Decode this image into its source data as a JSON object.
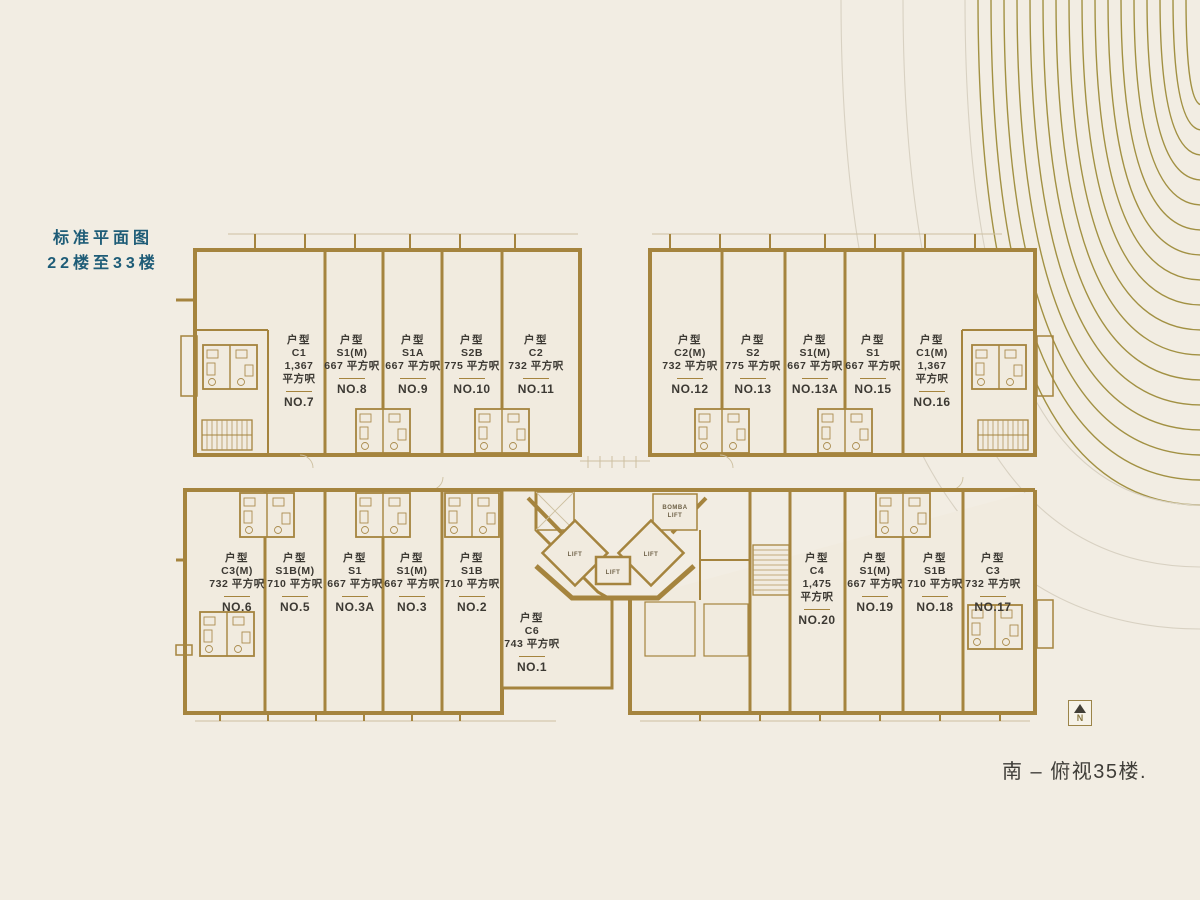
{
  "header": {
    "title_line1": "标准平面图",
    "title_line2": "22楼至33楼"
  },
  "plan": {
    "unit_prefix": "户型"
  },
  "units": {
    "top_left": [
      {
        "type": "C1",
        "area": "1,367 平方呎",
        "wrap": true,
        "no": "NO.7"
      },
      {
        "type": "S1(M)",
        "area": "667 平方呎",
        "wrap": false,
        "no": "NO.8"
      },
      {
        "type": "S1A",
        "area": "667 平方呎",
        "wrap": false,
        "no": "NO.9"
      },
      {
        "type": "S2B",
        "area": "775 平方呎",
        "wrap": false,
        "no": "NO.10"
      },
      {
        "type": "C2",
        "area": "732 平方呎",
        "wrap": false,
        "no": "NO.11"
      }
    ],
    "top_right": [
      {
        "type": "C2(M)",
        "area": "732 平方呎",
        "wrap": false,
        "no": "NO.12"
      },
      {
        "type": "S2",
        "area": "775 平方呎",
        "wrap": false,
        "no": "NO.13"
      },
      {
        "type": "S1(M)",
        "area": "667 平方呎",
        "wrap": false,
        "no": "NO.13A"
      },
      {
        "type": "S1",
        "area": "667 平方呎",
        "wrap": false,
        "no": "NO.15"
      },
      {
        "type": "C1(M)",
        "area": "1,367 平方呎",
        "wrap": true,
        "no": "NO.16"
      }
    ],
    "bottom_left": [
      {
        "type": "C3(M)",
        "area": "732 平方呎",
        "wrap": false,
        "no": "NO.6"
      },
      {
        "type": "S1B(M)",
        "area": "710 平方呎",
        "wrap": false,
        "no": "NO.5"
      },
      {
        "type": "S1",
        "area": "667 平方呎",
        "wrap": false,
        "no": "NO.3A"
      },
      {
        "type": "S1(M)",
        "area": "667 平方呎",
        "wrap": false,
        "no": "NO.3"
      },
      {
        "type": "S1B",
        "area": "710 平方呎",
        "wrap": false,
        "no": "NO.2"
      }
    ],
    "bottom_center": [
      {
        "type": "C6",
        "area": "743 平方呎",
        "wrap": false,
        "no": "NO.1"
      }
    ],
    "bottom_right": [
      {
        "type": "C4",
        "area": "1,475 平方呎",
        "wrap": true,
        "no": "NO.20"
      },
      {
        "type": "S1(M)",
        "area": "667 平方呎",
        "wrap": false,
        "no": "NO.19"
      },
      {
        "type": "S1B",
        "area": "710 平方呎",
        "wrap": false,
        "no": "NO.18"
      },
      {
        "type": "C3",
        "area": "732 平方呎",
        "wrap": false,
        "no": "NO.17"
      }
    ]
  },
  "core": {
    "lift": "LIFT",
    "bomba_line1": "BOMBA",
    "bomba_line2": "LIFT"
  },
  "compass": {
    "label": "N"
  },
  "footer": {
    "caption": "南 – 俯视35楼."
  },
  "colors": {
    "background": "#f2ede3",
    "wall": "#a5843e",
    "wall_thin": "#b2975e",
    "hairline": "#cdc0a0",
    "text": "#3c3933",
    "title": "#1e5c77",
    "arc_gold": "#a29143",
    "arc_gray": "#d8d1c2"
  }
}
